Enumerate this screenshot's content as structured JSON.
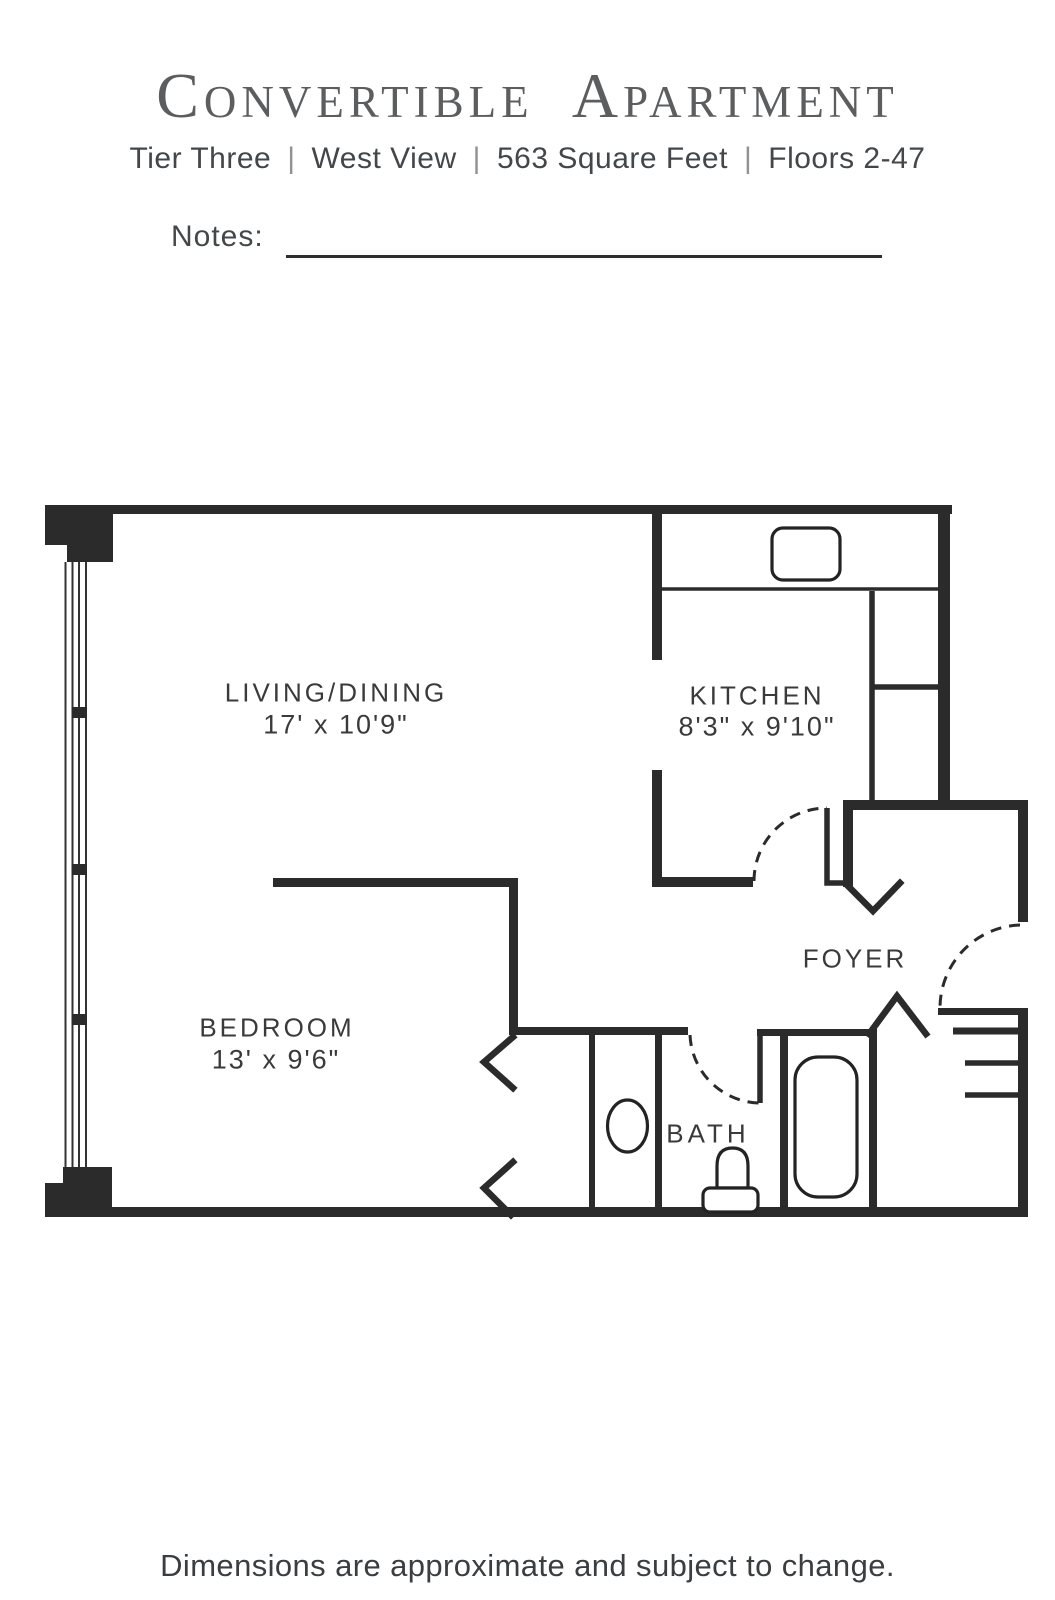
{
  "header": {
    "title_parts": [
      {
        "initial": "C",
        "rest": "ONVERTIBLE"
      },
      {
        "initial": "A",
        "rest": "PARTMENT"
      }
    ],
    "subtitle_items": [
      "Tier Three",
      "West View",
      "563 Square Feet",
      "Floors 2-47"
    ],
    "separator": "|"
  },
  "notes": {
    "label": "Notes:"
  },
  "floor_plan": {
    "rooms": [
      {
        "name": "LIVING/DINING",
        "dims": "17' x 10'9\""
      },
      {
        "name": "KITCHEN",
        "dims": "8'3\" x 9'10\""
      },
      {
        "name": "BEDROOM",
        "dims": "13' x 9'6\""
      },
      {
        "name": "FOYER",
        "dims": ""
      },
      {
        "name": "BATH",
        "dims": ""
      }
    ],
    "fixtures": [
      "kitchen-sink",
      "bath-tub",
      "toilet",
      "pedestal-sink",
      "window-wall",
      "closet-shelves",
      "entry-door",
      "kitchen-door",
      "bath-door",
      "closet-doors"
    ],
    "wall_color": "#2b2b2b",
    "text_color": "#3a3a3a"
  },
  "footer": {
    "disclaimer": "Dimensions are approximate and subject to change."
  }
}
